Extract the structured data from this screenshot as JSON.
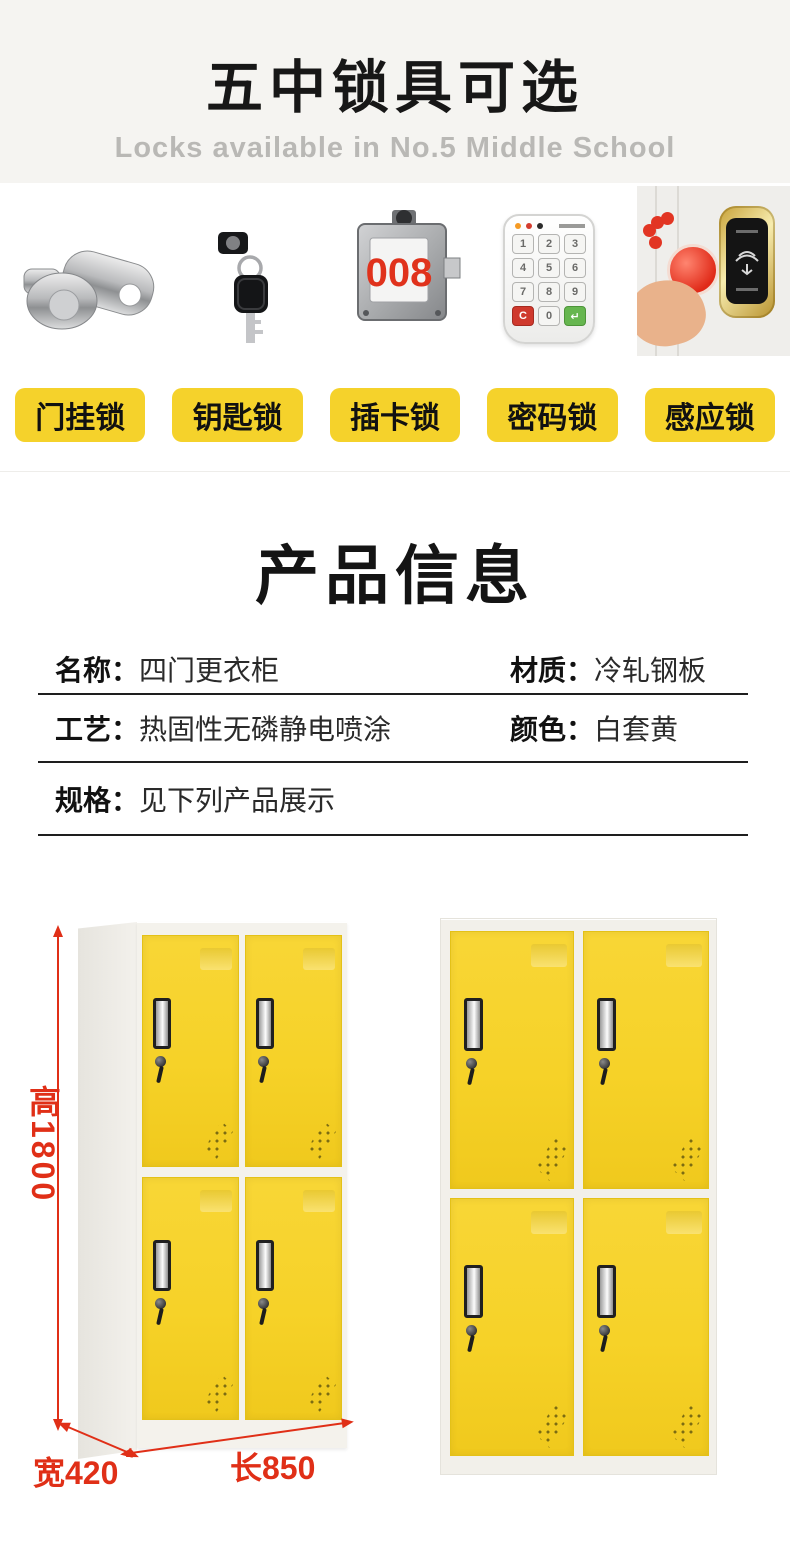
{
  "header": {
    "title": "五中锁具可选",
    "subtitle": "Locks available in No.5 Middle School"
  },
  "locks": {
    "tags": [
      "门挂锁",
      "钥匙锁",
      "插卡锁",
      "密码锁",
      "感应锁"
    ],
    "card_lock_number": "008",
    "keypad_keys": [
      "1",
      "2",
      "3",
      "4",
      "5",
      "6",
      "7",
      "8",
      "9",
      "C",
      "0",
      "↵"
    ]
  },
  "product_info": {
    "title": "产品信息",
    "rows": [
      {
        "cells": [
          {
            "label": "名称：",
            "value": "四门更衣柜"
          },
          {
            "label": "材质：",
            "value": "冷轧钢板"
          }
        ]
      },
      {
        "cells": [
          {
            "label": "工艺：",
            "value": "热固性无磷静电喷涂"
          },
          {
            "label": "颜色：",
            "value": "白套黄"
          }
        ]
      },
      {
        "cells": [
          {
            "label": "规格：",
            "value": "见下列产品展示"
          }
        ]
      }
    ]
  },
  "dimensions": {
    "height": "高1800",
    "width": "宽420",
    "length": "长850"
  },
  "colors": {
    "tag_yellow": "#f5d22b",
    "door_yellow": "#f6d228",
    "dimension_red": "#e02f17",
    "header_bg": "#f5f4f1"
  }
}
